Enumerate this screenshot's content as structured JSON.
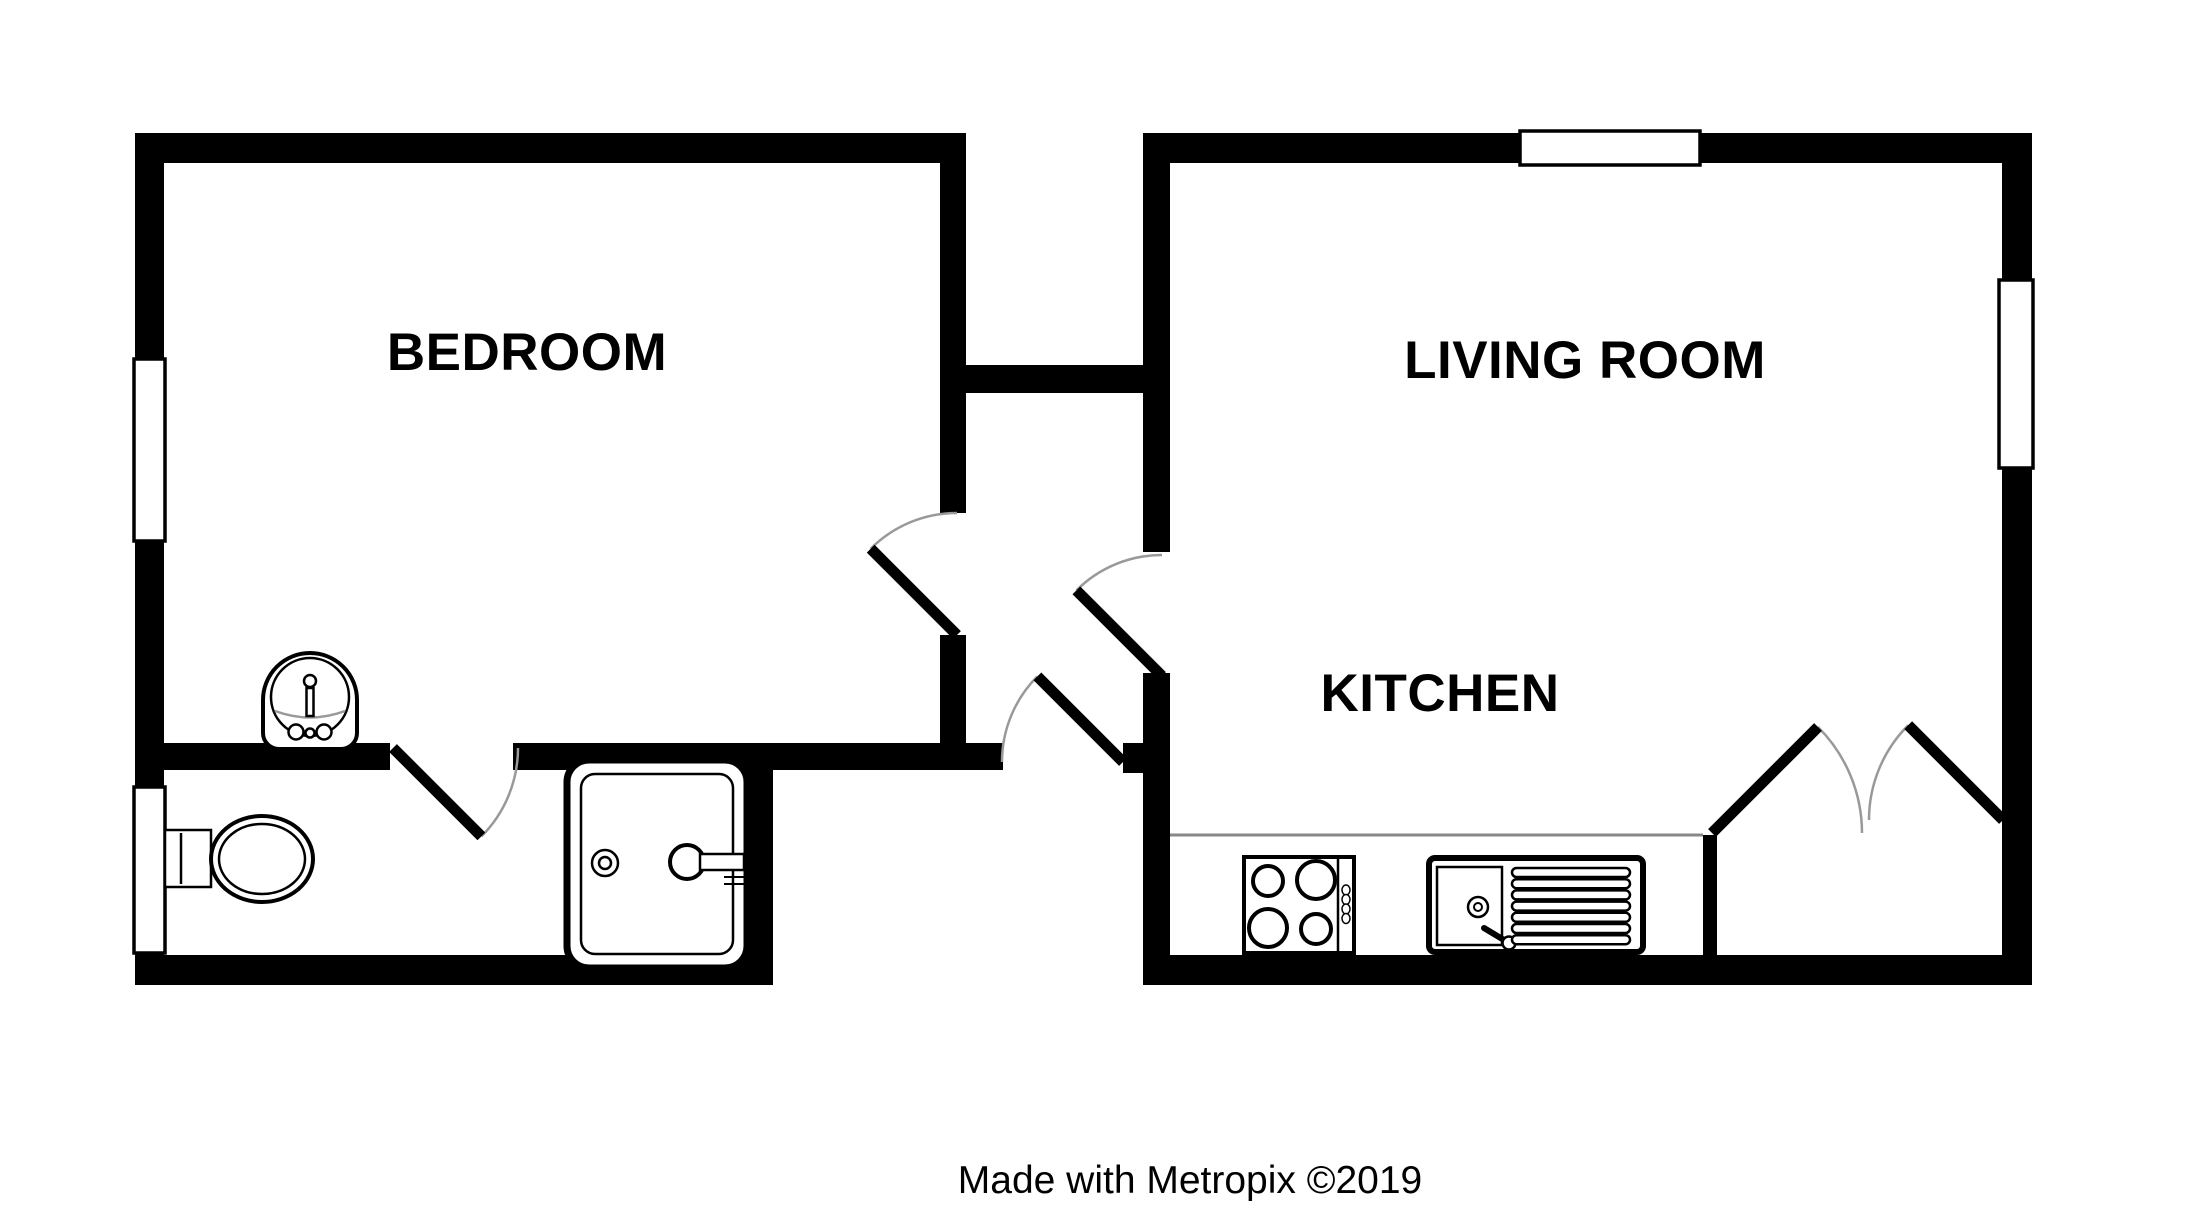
{
  "plan": {
    "rooms": [
      {
        "id": "bedroom",
        "label": "BEDROOM"
      },
      {
        "id": "living-room",
        "label": "LIVING ROOM"
      },
      {
        "id": "kitchen",
        "label": "KITCHEN"
      }
    ],
    "caption": "Made with Metropix ©2019",
    "fixtures": [
      "toilet",
      "wash-basin",
      "bath",
      "hob",
      "sink-drainer-unit",
      "kitchen-counter"
    ],
    "windows": [
      "bedroom-left-window",
      "bathroom-left-window",
      "living-room-top-window",
      "living-room-right-window"
    ],
    "doors": [
      "bedroom-door",
      "bathroom-door",
      "entrance-door",
      "living-room-door",
      "french-doors"
    ],
    "colors": {
      "wall": "#000000",
      "door_arc": "#999999",
      "counter_edge": "#888888",
      "background": "#ffffff",
      "text": "#000000"
    }
  }
}
